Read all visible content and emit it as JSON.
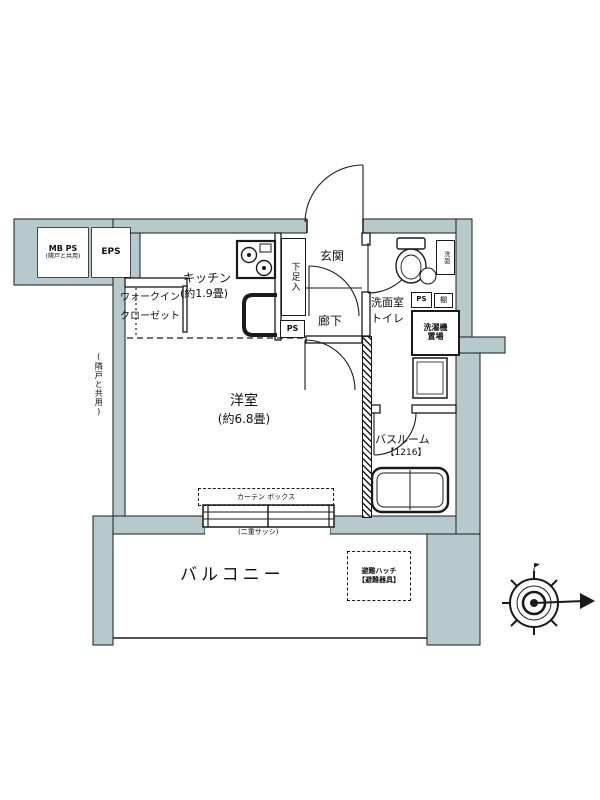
{
  "plan_title": "floor-plan",
  "annex": {
    "mb_ps": "MB PS",
    "mb_ps_note": "(隣戸と共用)",
    "eps": "EPS"
  },
  "rooms": {
    "kitchen_name": "キッチン",
    "kitchen_size": "(約1.9畳)",
    "wic_line1": "ウォークイン",
    "wic_line2": "クローゼット",
    "genkan": "玄関",
    "shoe_cabinet": "下足入",
    "hallway": "廊下",
    "washroom_line1": "洗面室",
    "washroom_line2": "トイレ",
    "living_name": "洋室",
    "living_size": "(約6.8畳)",
    "bath_name": "バスルーム",
    "bath_size": "【1216】",
    "balcony": "バルコニー"
  },
  "fixtures": {
    "ps_shoe": "PS",
    "ps_wash": "PS",
    "shelf": "棚",
    "washer_line1": "洗濯機",
    "washer_line2": "置場",
    "basin": "洗面"
  },
  "notes": {
    "curtain_box": "カーテン ボックス",
    "double_sash": "(二重サッシ)",
    "hatch_line1": "避難ハッチ",
    "hatch_line2": "【避難器具】",
    "side_wall_note": "(隣戸と共用)"
  },
  "icons": {
    "compass": "compass-rose-north-arrow",
    "stove": "gas-stove-two-burners",
    "sink": "kitchen-sink",
    "toilet": "toilet",
    "bathtub": "bathtub"
  },
  "colors": {
    "wall_fill": "#b6c9cc",
    "line": "#1a1a1a",
    "background": "#ffffff"
  }
}
